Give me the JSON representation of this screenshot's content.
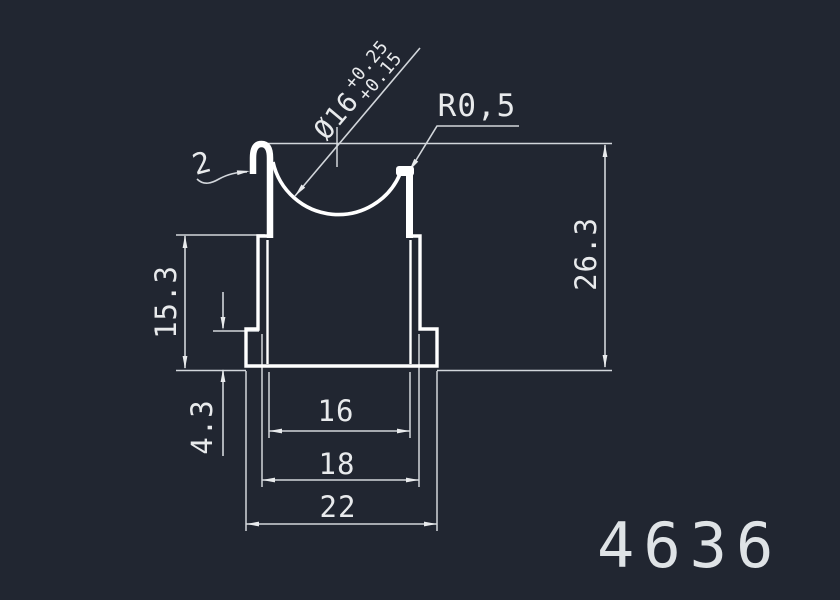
{
  "drawing": {
    "type": "technical-cross-section",
    "part_number": "4636",
    "dimensions": {
      "bore_diameter": "Ø16",
      "bore_tol_upper": "+0.25",
      "bore_tol_lower": "+0.15",
      "tip_radius": "R0,5",
      "wall_thickness": "2",
      "overall_height": "26.3",
      "body_height": "15.3",
      "base_height": "4.3",
      "slot_width": "16",
      "body_width": "18",
      "base_width": "22"
    },
    "colors": {
      "background": "#212631",
      "profile_line": "#ffffff",
      "dimension_line": "#d2d6db",
      "text": "#e8eaec"
    }
  }
}
